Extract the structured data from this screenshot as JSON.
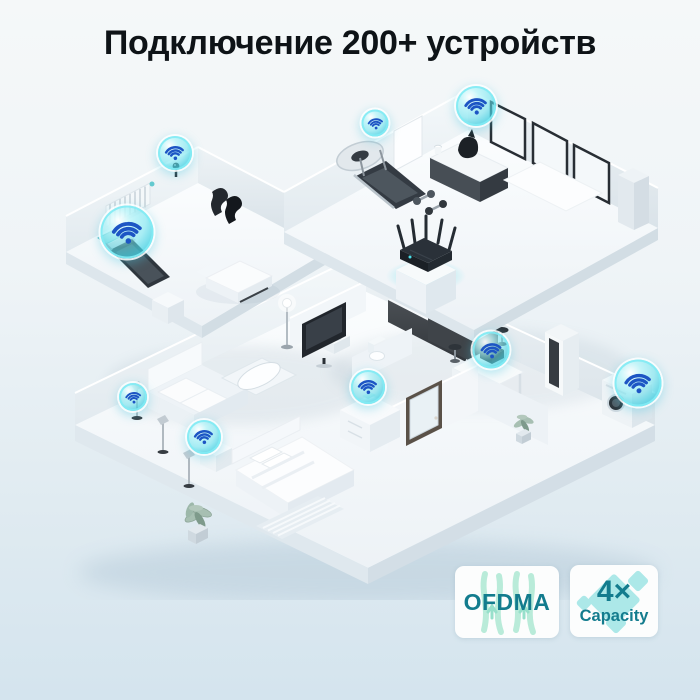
{
  "page": {
    "title": "Подключение 200+ устройств"
  },
  "colors": {
    "accent_teal": "#137C8E",
    "badge_mint": "#B9EBD9",
    "badge_cyan": "#ACE8E8",
    "bubble_cyan": "#3ECFE0",
    "wifi_symbol_blue": "#1D55C4",
    "title_color": "#0E1317"
  },
  "badges": {
    "ofdma": {
      "label": "OFDMA"
    },
    "capacity": {
      "value": "4×",
      "label": "Capacity"
    }
  },
  "router": {
    "x": 424,
    "y": 262
  },
  "wifi_devices": [
    {
      "x": 175,
      "y": 153,
      "d": 34,
      "device": "security-camera-upper-wall"
    },
    {
      "x": 127,
      "y": 232,
      "d": 53,
      "device": "treadmill-upper-left"
    },
    {
      "x": 375,
      "y": 123,
      "d": 27,
      "device": "exercise-machine-gym"
    },
    {
      "x": 476,
      "y": 106,
      "d": 40,
      "device": "smart-device-gym-desk"
    },
    {
      "x": 133,
      "y": 397,
      "d": 28,
      "device": "floor-lamp-living-room"
    },
    {
      "x": 204,
      "y": 437,
      "d": 34,
      "device": "nightstand-bedroom"
    },
    {
      "x": 368,
      "y": 387,
      "d": 34,
      "device": "smart-camera-dresser"
    },
    {
      "x": 491,
      "y": 350,
      "d": 37,
      "device": "printer-study-desk"
    },
    {
      "x": 638,
      "y": 383,
      "d": 47,
      "device": "washing-machine"
    }
  ]
}
